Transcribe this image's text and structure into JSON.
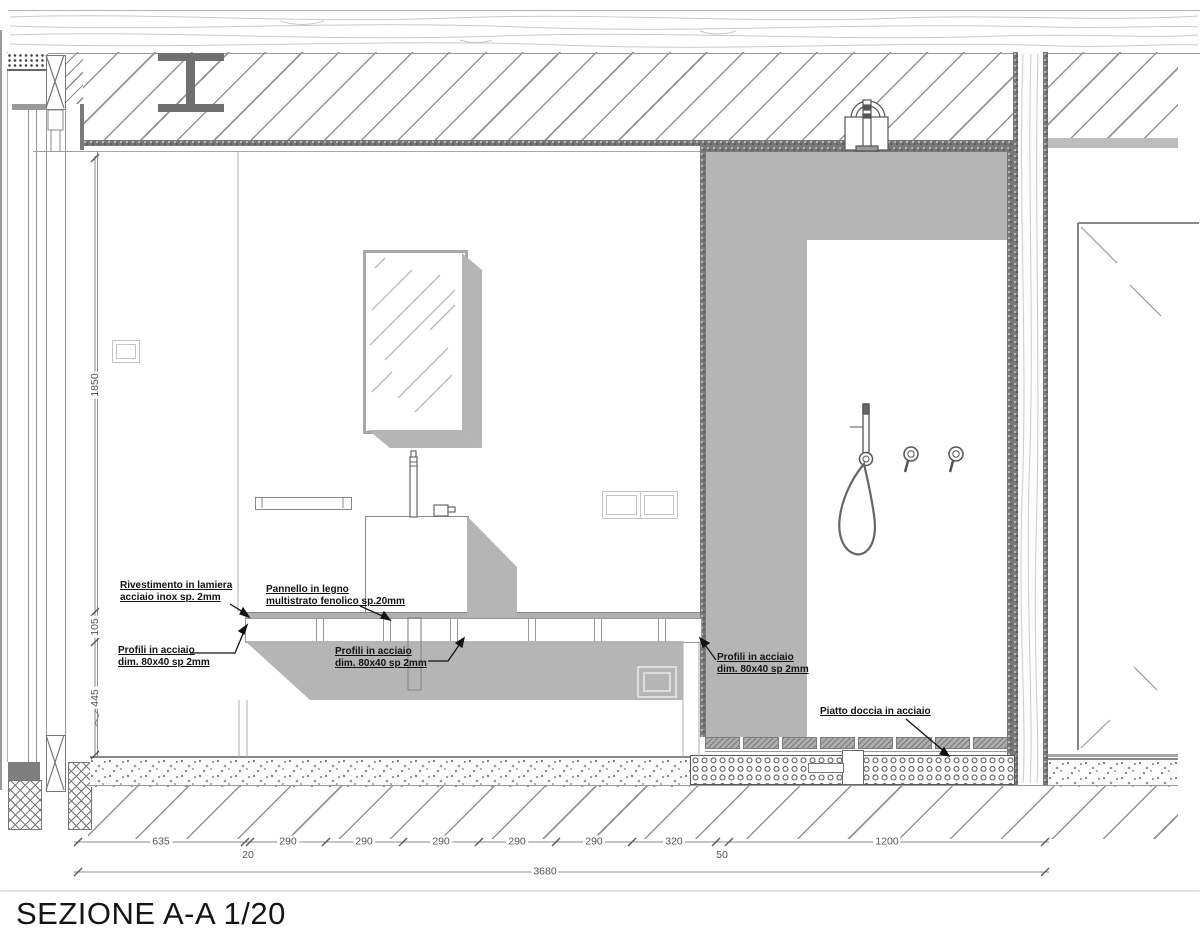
{
  "title": "SEZIONE A-A 1/20",
  "labels": {
    "rivestimento_1": "Rivestimento in lamiera",
    "rivestimento_2": "acciaio inox sp. 2mm",
    "pannello_1": "Pannello in legno",
    "pannello_2": "multistrato fenolico sp.20mm",
    "profili_1": "Profili in acciaio",
    "profili_2": "dim. 80x40 sp 2mm",
    "piatto": "Piatto doccia in acciaio"
  },
  "dimensions": {
    "vertical": [
      "1850",
      "105",
      "445"
    ],
    "bottom_row": [
      "635",
      "20",
      "290",
      "290",
      "290",
      "290",
      "290",
      "320",
      "50",
      "1200"
    ],
    "total": "3680"
  },
  "colors": {
    "fill_gray": "#b5b5b5",
    "hatch_line": "#949494",
    "dim_text": "#555555",
    "label_text": "#111111"
  }
}
